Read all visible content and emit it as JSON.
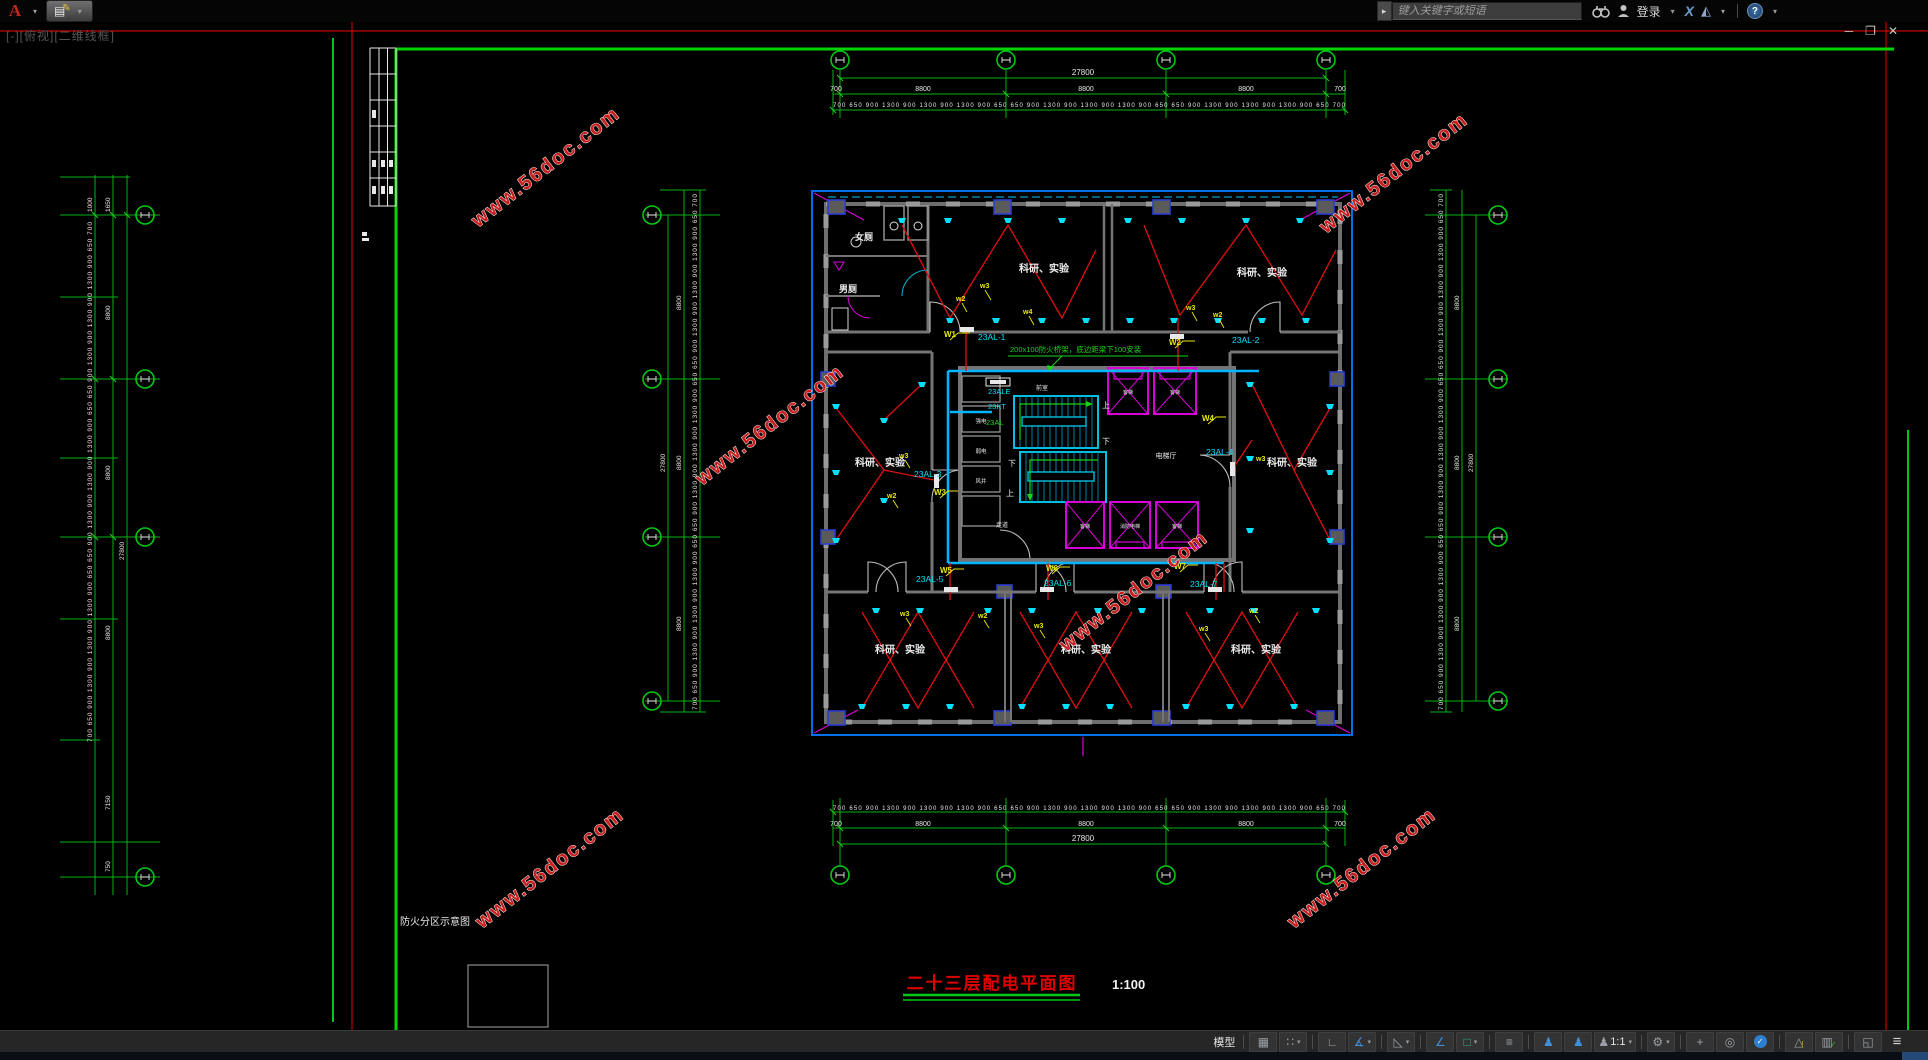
{
  "app": {
    "logo": "A",
    "caret": "▾",
    "qat_icon": "▤",
    "qat_pencil": "✎",
    "expander": "▸",
    "search_placeholder": "键入关键字或短语",
    "login": "登录",
    "exchange": "X",
    "a360": "◭",
    "help": "?"
  },
  "docwin": {
    "viewport": "[-][俯视][二维线框]",
    "min": "─",
    "restore": "❐",
    "close": "✕"
  },
  "statusbar": {
    "model": "模型",
    "grid": "▦",
    "snap": "∷",
    "ortho": "∟",
    "polar": "∡",
    "isodraft": "◺",
    "otrack": "∠",
    "osnap": "□",
    "lineweight": "≡",
    "person": "♟",
    "scale": "1:1",
    "gear": "⚙",
    "plus": "+",
    "isolate": "◎",
    "graphics_check": "✓",
    "monitor": "△",
    "warn": "!",
    "import": "▥",
    "fullscreen": "◱",
    "menu": "≡",
    "caret": "▾"
  },
  "drawing": {
    "watermark": "www.56doc.com",
    "title": "二十三层配电平面图",
    "scale": "1:100",
    "fire_note": "防火分区示意图",
    "cable_note": "200x100防火桥架，底边距梁下100安装",
    "rooms": {
      "lab": "科研、实验",
      "womens": "女厕",
      "mens": "男厕",
      "hall": "电梯厅",
      "vestibule": "前室",
      "corridor": "走道",
      "strong": "强电",
      "weak": "弱电",
      "shaft": "风井",
      "lift": "客梯",
      "fire_lift": "消防电梯"
    },
    "panels": {
      "p1": "23AL-1",
      "p2": "23AL-2",
      "p3": "23AL-3",
      "p4": "23AL-4",
      "p5": "23AL-5",
      "p6": "23AL-6",
      "p7": "23AL-7",
      "ale": "23ALE",
      "kt": "23KT",
      "al": "23AL"
    },
    "stairs": {
      "up": "上",
      "down": "下"
    },
    "wires": {
      "W1": "W1",
      "W2": "W2",
      "W3": "W3",
      "W4": "W4",
      "W5": "W5",
      "W6": "W6",
      "W7": "W7",
      "w2": "w2",
      "w3": "w3",
      "w4": "w4"
    },
    "dims": {
      "total": "27800",
      "bay": "8800",
      "end": "700",
      "fine": "700 650 900 1300 900 1300 900 1300 900 650 650 900 1300 900 1300 900 1300 900 650 650 900 1300 900 1300 900 1300 900 650 700",
      "lc_a": "1000",
      "lc_b": "1650",
      "lc_c": "7150",
      "lc_d": "750"
    }
  }
}
